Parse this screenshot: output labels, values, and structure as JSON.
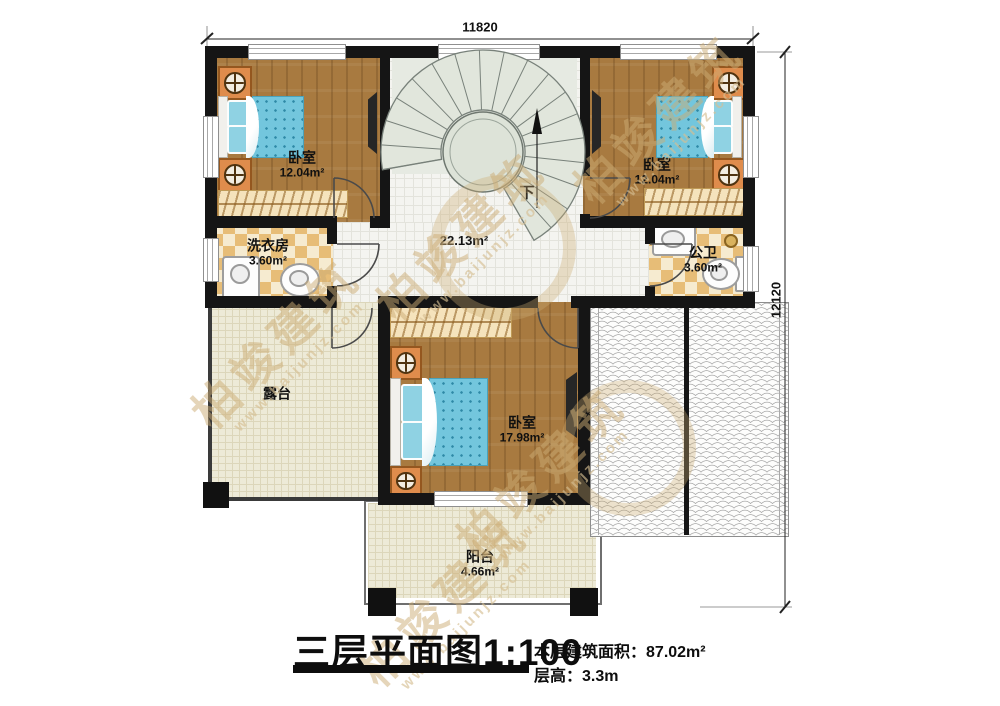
{
  "plan": {
    "dim_top": "11820",
    "dim_right": "12120"
  },
  "rooms": {
    "bedroom_tl": {
      "name": "卧室",
      "area": "12.04m²"
    },
    "bedroom_tr": {
      "name": "卧室",
      "area": "12.04m²"
    },
    "laundry": {
      "name": "洗衣房",
      "area": "3.60m²"
    },
    "bathroom": {
      "name": "公卫",
      "area": "3.60m²"
    },
    "hall": {
      "area": "22.13m²"
    },
    "bedroom_bottom": {
      "name": "卧室",
      "area": "17.98m²"
    },
    "terrace": {
      "name": "露台"
    },
    "balcony": {
      "name": "阳台",
      "area": "4.66m²"
    }
  },
  "stairs": {
    "down_label": "下"
  },
  "title_block": {
    "title": "三层平面图",
    "scale": "1:100",
    "area_label": "本层建筑面积：",
    "area_value": "87.02m²",
    "height_label": "层高：",
    "height_value": "3.3m"
  },
  "watermark": {
    "brand": "柏竣建筑",
    "url": "www.baijunjz.com"
  }
}
